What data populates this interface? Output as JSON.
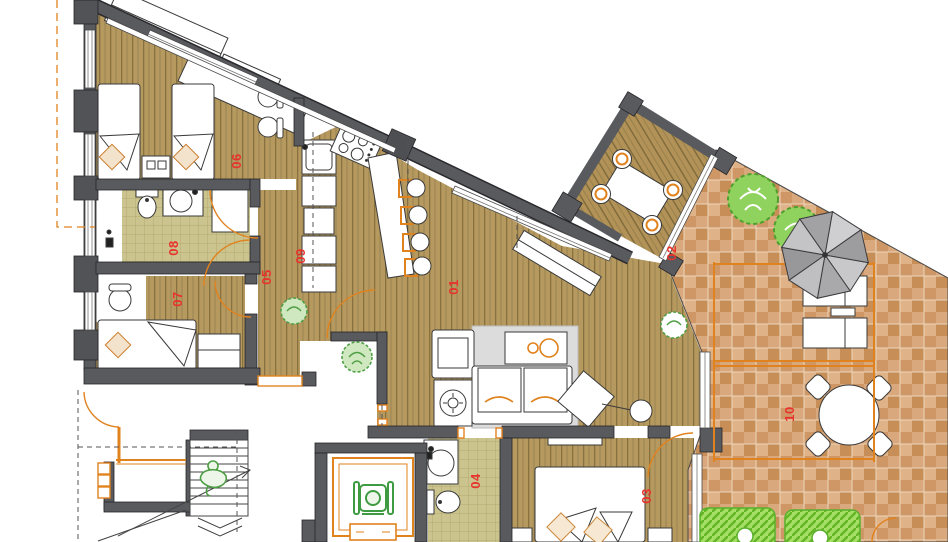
{
  "plan": {
    "title": "apartment-floor-plan",
    "rooms": [
      {
        "id": "room-01",
        "label": "01",
        "x": 458,
        "y": 287,
        "floor": "wood"
      },
      {
        "id": "room-02",
        "label": "02",
        "x": 676,
        "y": 253,
        "floor": "wood-rotated"
      },
      {
        "id": "room-03",
        "label": "03",
        "x": 651,
        "y": 496,
        "floor": "wood"
      },
      {
        "id": "room-04",
        "label": "04",
        "x": 480,
        "y": 481,
        "floor": "tile"
      },
      {
        "id": "room-05",
        "label": "05",
        "x": 271,
        "y": 277,
        "floor": "wood"
      },
      {
        "id": "room-06",
        "label": "06",
        "x": 241,
        "y": 161,
        "floor": "wood"
      },
      {
        "id": "room-07",
        "label": "07",
        "x": 182,
        "y": 299,
        "floor": "wood"
      },
      {
        "id": "room-08",
        "label": "08",
        "x": 178,
        "y": 248,
        "floor": "tile"
      },
      {
        "id": "room-09",
        "label": "09",
        "x": 305,
        "y": 256,
        "floor": "wood"
      },
      {
        "id": "room-10",
        "label": "10",
        "x": 794,
        "y": 414,
        "floor": "terracotta"
      }
    ],
    "label_rotation_deg": -90,
    "colors": {
      "wall": "#595a5e",
      "wall_dark": "#525357",
      "wall_edge": "#26262a",
      "wood_base": "#b6995f",
      "wood_line": "#86713f",
      "tile_base": "#ccc48e",
      "tile_line": "#b3aa6f",
      "terracotta_base": "#d9a87c",
      "terracotta_alt": "#c78e58",
      "orange": "#e0821e",
      "label_red": "#e8322c",
      "plant_green": "#6cc13b",
      "lounger_green": "#a5df66",
      "umbrella_light": "#c8c8ca",
      "umbrella_dark": "#9d9d9f",
      "rug_gray": "#dcdcdc"
    },
    "icons": [
      "umbrella-icon",
      "tree-icon",
      "plant-icon",
      "wheelchair-icon",
      "person-icon",
      "sun-lounger-icon",
      "stairs-icon",
      "door-swing-icon",
      "bed-icon",
      "double-bed-icon",
      "sofa-icon",
      "armchair-icon",
      "dining-table-icon",
      "round-table-icon",
      "bar-stool-icon",
      "chair-icon",
      "toilet-icon",
      "sink-icon",
      "shower-icon",
      "stove-icon",
      "washing-machine-icon",
      "tv-icon",
      "elevator-icon",
      "wardrobe-icon"
    ]
  }
}
